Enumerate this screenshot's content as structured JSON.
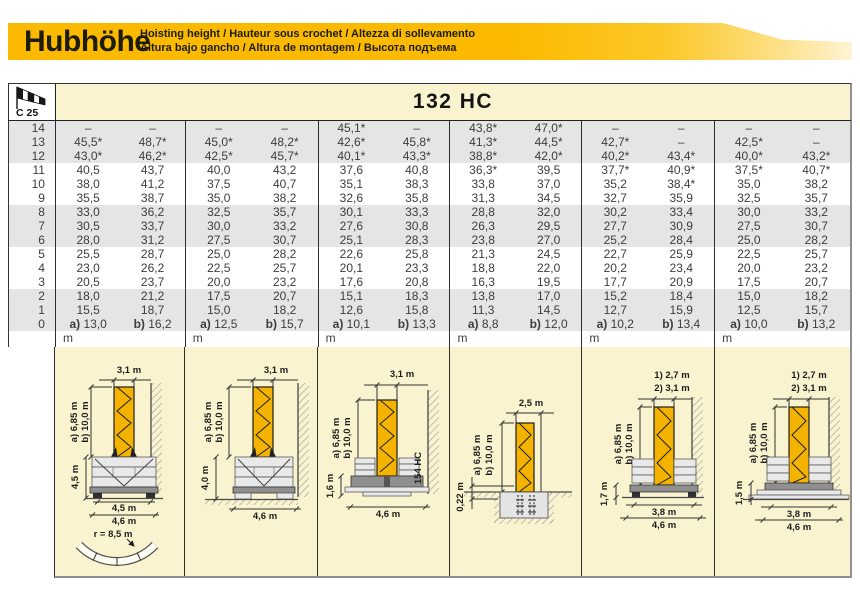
{
  "header": {
    "title": "Hubhöhe",
    "subtitle_line1": "Hoisting height / Hauteur sous crochet / Altezza di sollevamento",
    "subtitle_line2": "Altura bajo gancho / Altura de montagem / Высота подъема"
  },
  "badge": {
    "wind_label": "C 25"
  },
  "model": {
    "name": "132 HC"
  },
  "colors": {
    "band_yellow": "#FBBA00",
    "panel_cream": "#FAF3CF",
    "row_stripe": "#E5E5E5",
    "tower_yellow": "#F4B300"
  },
  "table": {
    "rows": [
      {
        "label": "14",
        "cells": [
          "–",
          "–",
          "–",
          "–",
          "45,1*",
          "–",
          "43,8*",
          "47,0*",
          "–",
          "–",
          "–",
          "–"
        ]
      },
      {
        "label": "13",
        "cells": [
          "45,5*",
          "48,7*",
          "45,0*",
          "48,2*",
          "42,6*",
          "45,8*",
          "41,3*",
          "44,5*",
          "42,7*",
          "–",
          "42,5*",
          "–"
        ]
      },
      {
        "label": "12",
        "cells": [
          "43,0*",
          "46,2*",
          "42,5*",
          "45,7*",
          "40,1*",
          "43,3*",
          "38,8*",
          "42,0*",
          "40,2*",
          "43,4*",
          "40,0*",
          "43,2*"
        ]
      },
      {
        "label": "11",
        "cells": [
          "40,5",
          "43,7",
          "40,0",
          "43,2",
          "37,6",
          "40,8",
          "36,3*",
          "39,5",
          "37,7*",
          "40,9*",
          "37,5*",
          "40,7*"
        ]
      },
      {
        "label": "10",
        "cells": [
          "38,0",
          "41,2",
          "37,5",
          "40,7",
          "35,1",
          "38,3",
          "33,8",
          "37,0",
          "35,2",
          "38,4*",
          "35,0",
          "38,2"
        ]
      },
      {
        "label": "9",
        "cells": [
          "35,5",
          "38,7",
          "35,0",
          "38,2",
          "32,6",
          "35,8",
          "31,3",
          "34,5",
          "32,7",
          "35,9",
          "32,5",
          "35,7"
        ]
      },
      {
        "label": "8",
        "cells": [
          "33,0",
          "36,2",
          "32,5",
          "35,7",
          "30,1",
          "33,3",
          "28,8",
          "32,0",
          "30,2",
          "33,4",
          "30,0",
          "33,2"
        ]
      },
      {
        "label": "7",
        "cells": [
          "30,5",
          "33,7",
          "30,0",
          "33,2",
          "27,6",
          "30,8",
          "26,3",
          "29,5",
          "27,7",
          "30,9",
          "27,5",
          "30,7"
        ]
      },
      {
        "label": "6",
        "cells": [
          "28,0",
          "31,2",
          "27,5",
          "30,7",
          "25,1",
          "28,3",
          "23,8",
          "27,0",
          "25,2",
          "28,4",
          "25,0",
          "28,2"
        ]
      },
      {
        "label": "5",
        "cells": [
          "25,5",
          "28,7",
          "25,0",
          "28,2",
          "22,6",
          "25,8",
          "21,3",
          "24,5",
          "22,7",
          "25,9",
          "22,5",
          "25,7"
        ]
      },
      {
        "label": "4",
        "cells": [
          "23,0",
          "26,2",
          "22,5",
          "25,7",
          "20,1",
          "23,3",
          "18,8",
          "22,0",
          "20,2",
          "23,4",
          "20,0",
          "23,2"
        ]
      },
      {
        "label": "3",
        "cells": [
          "20,5",
          "23,7",
          "20,0",
          "23,2",
          "17,6",
          "20,8",
          "16,3",
          "19,5",
          "17,7",
          "20,9",
          "17,5",
          "20,7"
        ]
      },
      {
        "label": "2",
        "cells": [
          "18,0",
          "21,2",
          "17,5",
          "20,7",
          "15,1",
          "18,3",
          "13,8",
          "17,0",
          "15,2",
          "18,4",
          "15,0",
          "18,2"
        ]
      },
      {
        "label": "1",
        "cells": [
          "15,5",
          "18,7",
          "15,0",
          "18,2",
          "12,6",
          "15,8",
          "11,3",
          "14,5",
          "12,7",
          "15,9",
          "12,5",
          "15,7"
        ]
      },
      {
        "label": "0",
        "cells": [
          "a) 13,0",
          "b) 16,2",
          "a) 12,5",
          "b) 15,7",
          "a) 10,1",
          "b) 13,3",
          "a) 8,8",
          "b) 12,0",
          "a) 10,2",
          "b) 13,4",
          "a) 10,0",
          "b) 13,2"
        ]
      }
    ],
    "unit_row": [
      "m",
      "m",
      "m",
      "m",
      "m",
      "m"
    ]
  },
  "diagrams": [
    {
      "top_width": "3,1 m",
      "mast_a": "a) 6,85 m",
      "mast_b": "b) 10,0 m",
      "base_height": "4,5 m",
      "track_width": "4,5 m",
      "overall_width": "4,6 m",
      "radius": "r = 8,5 m"
    },
    {
      "top_width": "3,1 m",
      "mast_a": "a) 6,85 m",
      "mast_b": "b) 10,0 m",
      "base_height": "4,0 m",
      "overall_width": "4,6 m"
    },
    {
      "top_width": "3,1 m",
      "mast_a": "a) 6,85 m",
      "mast_b": "b) 10,0 m",
      "base_height": "1,6 m",
      "overall_width": "4,6 m",
      "tower_type": "154 HC"
    },
    {
      "top_width": "2,5 m",
      "mast_a": "a) 6,85 m",
      "mast_b": "b) 10,0 m",
      "depth": "0,22 m"
    },
    {
      "top_width_1": "1) 2,7 m",
      "top_width_2": "2) 3,1 m",
      "mast_a": "a) 6,85 m",
      "mast_b": "b) 10,0 m",
      "base_height": "1,7 m",
      "track_width": "3,8 m",
      "overall_width": "4,6 m"
    },
    {
      "top_width_1": "1) 2,7 m",
      "top_width_2": "2) 3,1 m",
      "mast_a": "a) 6,85 m",
      "mast_b": "b) 10,0 m",
      "base_height": "1,5 m",
      "track_width": "3,8 m",
      "overall_width": "4,6 m"
    }
  ]
}
